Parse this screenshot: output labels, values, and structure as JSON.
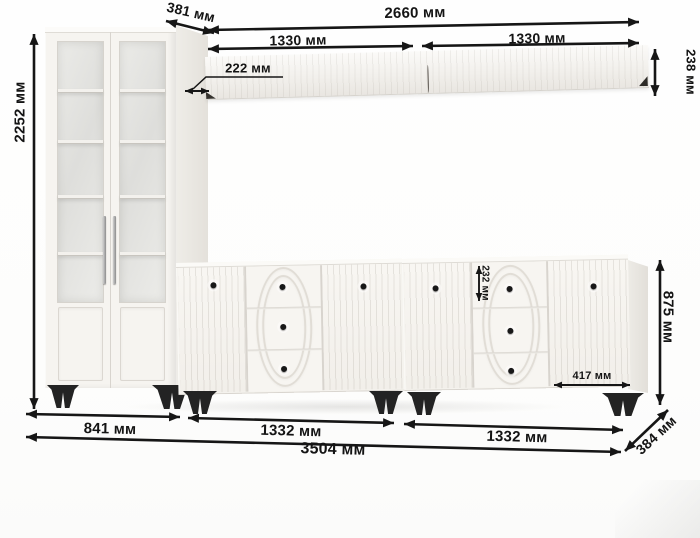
{
  "diagram_title": "furniture wall unit dimensions",
  "dimensions": {
    "total_height": "2252 мм",
    "cabinet_depth": "381 мм",
    "shelf_total_width": "2660 мм",
    "shelf_left_width": "1330 мм",
    "shelf_right_width": "1330 мм",
    "shelf_depth": "222 мм",
    "shelf_height": "238 мм",
    "top_drawer_height": "232 мм",
    "sideboard_height": "875 мм",
    "sideboard_door_width": "417 мм",
    "cabinet_width": "841 мм",
    "sideboard_left_width": "1332 мм",
    "sideboard_right_width": "1332 мм",
    "total_width": "3504 мм",
    "sideboard_depth": "384 мм"
  },
  "colors": {
    "furniture_body": "#f6f4f0",
    "legs": "#232323",
    "dimension_lines": "#161616",
    "background": "#fdfdfc"
  }
}
